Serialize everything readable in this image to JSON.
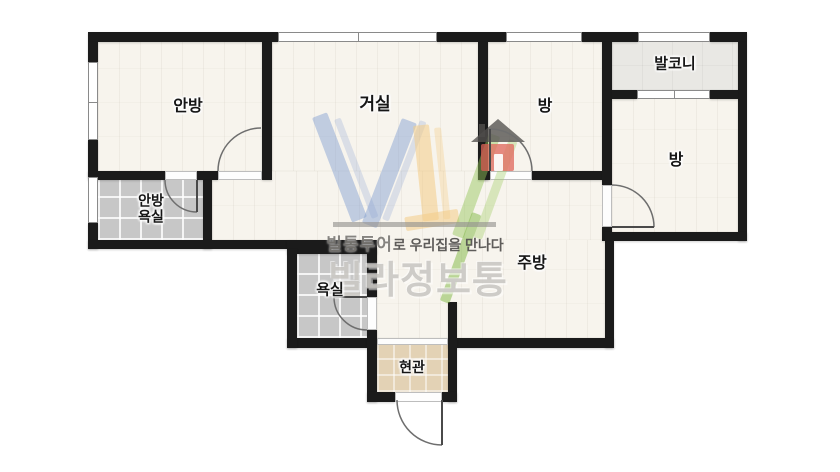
{
  "watermark": {
    "tagline_bold": "빌통투어",
    "tagline_rest": "로 우리집을 만나다",
    "brand": "빌라정보통"
  },
  "colors": {
    "wall": "#1b1b1b",
    "floor_wood": "#f7f4ed",
    "floor_tile": "#c7c7c7",
    "floor_balcony": "#e9e8e4",
    "floor_entry": "#e3d2b5",
    "brand_blue": "#7a98ce",
    "brand_yellow": "#f3c97d",
    "brand_green": "#94c658",
    "brand_red": "#df6357"
  },
  "plan": {
    "canvas": {
      "w": 840,
      "h": 472
    },
    "rooms": [
      {
        "id": "master-bedroom",
        "label": "안방",
        "x": 188,
        "y": 107,
        "size": 16
      },
      {
        "id": "living-room",
        "label": "거실",
        "x": 375,
        "y": 104,
        "size": 17
      },
      {
        "id": "room-center",
        "label": "방",
        "x": 545,
        "y": 107,
        "size": 16
      },
      {
        "id": "balcony",
        "label": "발코니",
        "x": 675,
        "y": 65,
        "size": 15
      },
      {
        "id": "room-right",
        "label": "방",
        "x": 676,
        "y": 161,
        "size": 16
      },
      {
        "id": "master-bath",
        "label": "안방\n욕실",
        "x": 151,
        "y": 209,
        "size": 14
      },
      {
        "id": "bathroom",
        "label": "욕실",
        "x": 330,
        "y": 291,
        "size": 15
      },
      {
        "id": "kitchen",
        "label": "주방",
        "x": 532,
        "y": 264,
        "size": 16
      },
      {
        "id": "entry",
        "label": "현관",
        "x": 412,
        "y": 368,
        "size": 14
      }
    ],
    "floors": [
      {
        "id": "master-bedroom",
        "type": "wood",
        "x": 98,
        "y": 42,
        "w": 164,
        "h": 129
      },
      {
        "id": "living-room",
        "type": "wood",
        "x": 272,
        "y": 42,
        "w": 206,
        "h": 129
      },
      {
        "id": "room-center",
        "type": "wood",
        "x": 488,
        "y": 42,
        "w": 114,
        "h": 129
      },
      {
        "id": "balcony",
        "type": "balcony",
        "x": 612,
        "y": 42,
        "w": 126,
        "h": 48
      },
      {
        "id": "room-right",
        "type": "wood",
        "x": 612,
        "y": 99,
        "w": 126,
        "h": 133
      },
      {
        "id": "hall-strip",
        "type": "wood",
        "x": 212,
        "y": 171,
        "w": 393,
        "h": 69
      },
      {
        "id": "kitchen",
        "type": "wood",
        "x": 377,
        "y": 240,
        "w": 228,
        "h": 98
      },
      {
        "id": "master-bath",
        "type": "tile",
        "x": 98,
        "y": 180,
        "w": 105,
        "h": 60
      },
      {
        "id": "bathroom",
        "type": "tile",
        "x": 297,
        "y": 249,
        "w": 70,
        "h": 89
      },
      {
        "id": "entry",
        "type": "entry",
        "x": 377,
        "y": 345,
        "w": 71,
        "h": 47
      }
    ],
    "walls": [
      {
        "x": 88,
        "y": 32,
        "w": 190,
        "h": 10
      },
      {
        "x": 437,
        "y": 32,
        "w": 69,
        "h": 10
      },
      {
        "x": 582,
        "y": 32,
        "w": 56,
        "h": 10
      },
      {
        "x": 710,
        "y": 32,
        "w": 37,
        "h": 10
      },
      {
        "x": 88,
        "y": 42,
        "w": 10,
        "h": 20
      },
      {
        "x": 88,
        "y": 140,
        "w": 10,
        "h": 37
      },
      {
        "x": 88,
        "y": 223,
        "w": 10,
        "h": 26
      },
      {
        "x": 262,
        "y": 42,
        "w": 10,
        "h": 138
      },
      {
        "x": 88,
        "y": 171,
        "w": 77,
        "h": 9
      },
      {
        "x": 197,
        "y": 171,
        "w": 21,
        "h": 9
      },
      {
        "x": 203,
        "y": 180,
        "w": 9,
        "h": 69
      },
      {
        "x": 88,
        "y": 240,
        "w": 209,
        "h": 9
      },
      {
        "x": 287,
        "y": 240,
        "w": 90,
        "h": 14
      },
      {
        "x": 478,
        "y": 42,
        "w": 10,
        "h": 138
      },
      {
        "x": 478,
        "y": 171,
        "w": 12,
        "h": 9
      },
      {
        "x": 532,
        "y": 171,
        "w": 73,
        "h": 9
      },
      {
        "x": 602,
        "y": 42,
        "w": 10,
        "h": 143
      },
      {
        "x": 602,
        "y": 227,
        "w": 10,
        "h": 14
      },
      {
        "x": 738,
        "y": 42,
        "w": 9,
        "h": 199
      },
      {
        "x": 612,
        "y": 90,
        "w": 25,
        "h": 9
      },
      {
        "x": 710,
        "y": 90,
        "w": 28,
        "h": 9
      },
      {
        "x": 605,
        "y": 232,
        "w": 142,
        "h": 9
      },
      {
        "x": 605,
        "y": 241,
        "w": 9,
        "h": 107
      },
      {
        "x": 287,
        "y": 338,
        "w": 90,
        "h": 10
      },
      {
        "x": 448,
        "y": 338,
        "w": 166,
        "h": 10
      },
      {
        "x": 287,
        "y": 249,
        "w": 10,
        "h": 99
      },
      {
        "x": 367,
        "y": 249,
        "w": 10,
        "h": 48
      },
      {
        "x": 367,
        "y": 330,
        "w": 10,
        "h": 72
      },
      {
        "x": 448,
        "y": 302,
        "w": 9,
        "h": 100
      },
      {
        "x": 367,
        "y": 392,
        "w": 28,
        "h": 10
      },
      {
        "x": 442,
        "y": 392,
        "w": 15,
        "h": 10
      }
    ],
    "windows": [
      {
        "x": 278,
        "y": 32,
        "w": 159,
        "h": 10,
        "mx": 357
      },
      {
        "x": 506,
        "y": 32,
        "w": 76,
        "h": 10
      },
      {
        "x": 638,
        "y": 32,
        "w": 72,
        "h": 10
      },
      {
        "x": 637,
        "y": 90,
        "w": 73,
        "h": 9,
        "mx": 673
      },
      {
        "x": 88,
        "y": 62,
        "w": 10,
        "h": 78,
        "my": 101
      },
      {
        "x": 88,
        "y": 177,
        "w": 10,
        "h": 46
      }
    ],
    "thresholds": [
      {
        "x": 218,
        "y": 171,
        "w": 44,
        "h": 9
      },
      {
        "x": 165,
        "y": 171,
        "w": 32,
        "h": 9
      },
      {
        "x": 490,
        "y": 171,
        "w": 42,
        "h": 9
      },
      {
        "x": 602,
        "y": 185,
        "w": 10,
        "h": 42
      },
      {
        "x": 367,
        "y": 297,
        "w": 10,
        "h": 33
      },
      {
        "x": 395,
        "y": 392,
        "w": 47,
        "h": 10
      },
      {
        "x": 377,
        "y": 338,
        "w": 71,
        "h": 7
      }
    ],
    "doors": [
      {
        "id": "master-bedroom-door",
        "path": "M 218 171 A 43 43 0 0 1 261 128",
        "leaf": null
      },
      {
        "id": "master-bath-door",
        "path": "M 165 180 A 32 32 0 0 0 197 212",
        "leaf": [
          197,
          180,
          197,
          212
        ]
      },
      {
        "id": "room-center-door",
        "path": "M 532 171 A 42 42 0 0 0 490 129",
        "leaf": [
          490,
          171,
          490,
          129
        ]
      },
      {
        "id": "room-right-door",
        "path": "M 612 185 A 42 42 0 0 1 654 227",
        "leaf": [
          612,
          227,
          654,
          227
        ]
      },
      {
        "id": "bathroom-door",
        "path": "M 334 297 A 33 33 0 0 0 367 330",
        "leaf": [
          334,
          297,
          367,
          297
        ]
      },
      {
        "id": "front-door",
        "path": "M 397 400 A 45 45 0 0 0 442 445",
        "leaf": [
          442,
          400,
          442,
          445
        ]
      }
    ]
  }
}
